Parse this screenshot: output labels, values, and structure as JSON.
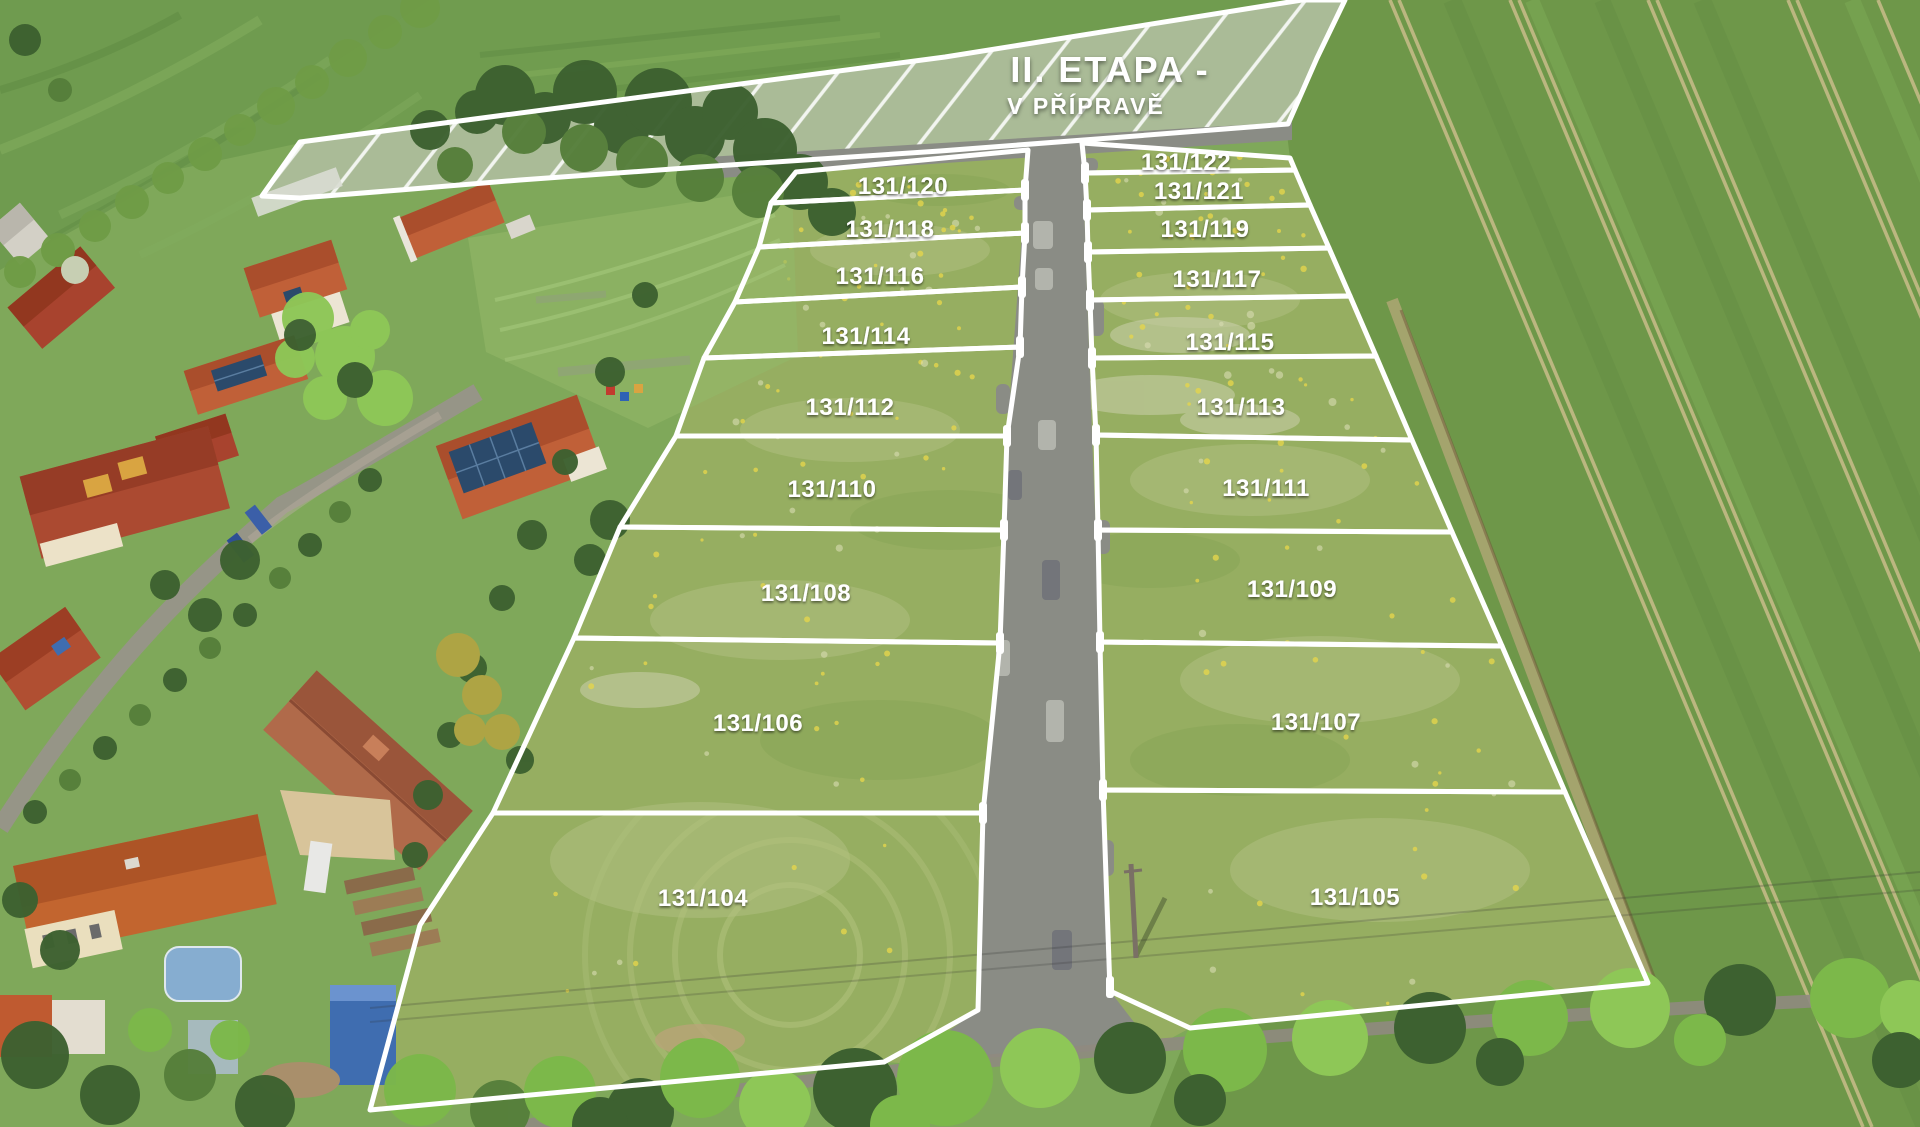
{
  "overlay": {
    "phase_label": "II. ETAPA -",
    "phase_sublabel": "V PŘÍPRAVĚ"
  },
  "parcels": {
    "left": [
      {
        "label": "131/120"
      },
      {
        "label": "131/118"
      },
      {
        "label": "131/116"
      },
      {
        "label": "131/114"
      },
      {
        "label": "131/112"
      },
      {
        "label": "131/110"
      },
      {
        "label": "131/108"
      },
      {
        "label": "131/106"
      },
      {
        "label": "131/104"
      }
    ],
    "right": [
      {
        "label": "131/122"
      },
      {
        "label": "131/121"
      },
      {
        "label": "131/119"
      },
      {
        "label": "131/117"
      },
      {
        "label": "131/115"
      },
      {
        "label": "131/113"
      },
      {
        "label": "131/111"
      },
      {
        "label": "131/109"
      },
      {
        "label": "131/107"
      },
      {
        "label": "131/105"
      }
    ]
  },
  "colors": {
    "line_white": "#ffffff",
    "village_green": "#7fa85a",
    "field_top": "#6f9b4f",
    "field_right": "#6e9749",
    "meadow": "#96ae61",
    "hatch_fill": "#b6c0a8",
    "road": "#8a8c85",
    "road_bay_light": "#b2b4ac",
    "road_bay_dark": "#73757a",
    "street": "#98938a",
    "tramline": "#c9bd8a",
    "dirt": "#b7a87a",
    "tree_dark": "#3d6130",
    "tree_bright": "#7cb84a",
    "roof_orange": "#c06038",
    "roof_red": "#a8432e",
    "solar_blue": "#2b4a6b"
  }
}
